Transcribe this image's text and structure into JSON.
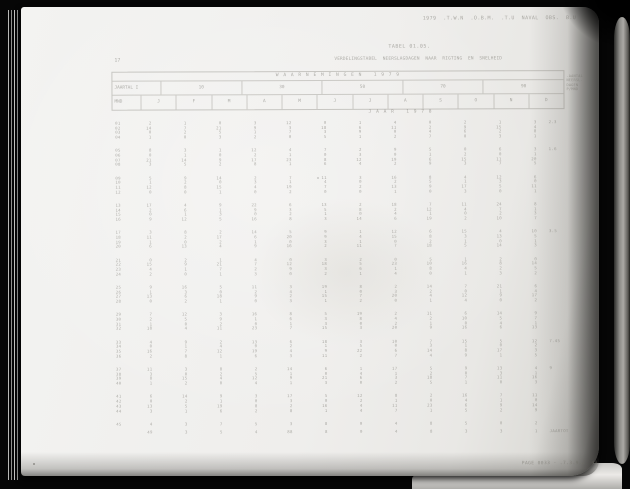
{
  "scan": {
    "top_right_line": "1979  .T.W.N  .O.B.M.  .T.U  NAVAL  OBS.  B.U",
    "table_ref": "TABEL 01.05.",
    "station_no": "17",
    "title_line": "VERDELINGSTABEL  NEERSLAGDAGEN  NAAR  RIGTING  EN  SNELHEID",
    "footer_line": "PAGE 0033 - .7.3.9.3  49"
  },
  "table": {
    "spanner": "W A A R N E M I N G E N   1 9 7 9",
    "year_label_cell": "JAARTAL I",
    "group_headers": [
      "10",
      "30",
      "50",
      "70",
      "90"
    ],
    "unit_cell": "MND",
    "month_headers": [
      "J",
      "F",
      "M",
      "A",
      "M",
      "J",
      "J",
      "A",
      "S",
      "O",
      "N",
      "D"
    ],
    "side_note_lines": [
      "-AANTAL",
      "NEERSL.",
      "DAGEN",
      "P/MND"
    ],
    "subtitle": "J A A R   1 9 7 8"
  },
  "table_body": {
    "groups": [
      {
        "note": "2.3",
        "rows": [
          {
            "label": "01",
            "values": [
              "2",
              "1",
              "0",
              "3",
              "12",
              "0",
              "1",
              "4",
              "0",
              "2",
              "1",
              "3"
            ]
          },
          {
            "label": "02",
            "values": [
              "14",
              "7",
              "21",
              "9",
              "3",
              "18",
              "6",
              "11",
              "2",
              "9",
              "15",
              "4"
            ]
          },
          {
            "label": "03",
            "values": [
              "0",
              "2",
              "5",
              "1",
              "7",
              "3",
              "9",
              "0",
              "4",
              "6",
              "2",
              "8"
            ]
          },
          {
            "label": "04",
            "values": [
              "1",
              "0",
              "3",
              "2",
              "0",
              "5",
              "1",
              "2",
              "7",
              "0",
              "3",
              "1"
            ]
          }
        ]
      },
      {
        "note": "1.6",
        "rows": [
          {
            "label": "05",
            "values": [
              "8",
              "3",
              "1",
              "12",
              "4",
              "7",
              "2",
              "9",
              "5",
              "0",
              "6",
              "3"
            ]
          },
          {
            "label": "06",
            "values": [
              "0",
              "1",
              "0",
              "2",
              "1",
              "0",
              "3",
              "0",
              "1",
              "2",
              "0",
              "1"
            ]
          },
          {
            "label": "07",
            "values": [
              "21",
              "14",
              "9",
              "17",
              "23",
              "8",
              "12",
              "19",
              "6",
              "15",
              "11",
              "20"
            ]
          },
          {
            "label": "08",
            "values": [
              "3",
              "5",
              "2",
              "8",
              "1",
              "6",
              "4",
              "2",
              "9",
              "3",
              "7",
              "5"
            ]
          }
        ]
      },
      {
        "note": "",
        "rows": [
          {
            "label": "09",
            "values": [
              "5",
              "9",
              "14",
              "2",
              "7",
              "11",
              "3",
              "16",
              "8",
              "4",
              "12",
              "6"
            ]
          },
          {
            "label": "10",
            "values": [
              "1",
              "2",
              "0",
              "3",
              "1",
              "4",
              "0",
              "2",
              "5",
              "1",
              "3",
              "0"
            ]
          },
          {
            "label": "11",
            "values": [
              "12",
              "8",
              "15",
              "4",
              "19",
              "7",
              "2",
              "13",
              "9",
              "17",
              "5",
              "11"
            ]
          },
          {
            "label": "12",
            "values": [
              "0",
              "0",
              "1",
              "0",
              "2",
              "0",
              "0",
              "1",
              "0",
              "3",
              "0",
              "1"
            ]
          }
        ]
      },
      {
        "note": "",
        "rows": [
          {
            "label": "13",
            "values": [
              "17",
              "4",
              "9",
              "22",
              "6",
              "13",
              "2",
              "18",
              "7",
              "11",
              "24",
              "8"
            ]
          },
          {
            "label": "14",
            "values": [
              "2",
              "6",
              "1",
              "9",
              "3",
              "5",
              "8",
              "2",
              "12",
              "4",
              "7",
              "1"
            ]
          },
          {
            "label": "15",
            "values": [
              "0",
              "1",
              "3",
              "0",
              "2",
              "1",
              "0",
              "4",
              "1",
              "0",
              "2",
              "3"
            ]
          },
          {
            "label": "16",
            "values": [
              "9",
              "12",
              "5",
              "16",
              "8",
              "3",
              "14",
              "6",
              "19",
              "2",
              "10",
              "7"
            ]
          }
        ]
      },
      {
        "note": "3.5",
        "rows": [
          {
            "label": "17",
            "values": [
              "3",
              "8",
              "2",
              "14",
              "5",
              "9",
              "1",
              "12",
              "6",
              "15",
              "4",
              "10"
            ]
          },
          {
            "label": "18",
            "values": [
              "11",
              "2",
              "17",
              "6",
              "20",
              "9",
              "4",
              "15",
              "8",
              "3",
              "13",
              "5"
            ]
          },
          {
            "label": "19",
            "values": [
              "1",
              "0",
              "2",
              "1",
              "0",
              "3",
              "1",
              "0",
              "2",
              "1",
              "0",
              "1"
            ]
          },
          {
            "label": "20",
            "values": [
              "6",
              "13",
              "4",
              "9",
              "16",
              "2",
              "11",
              "7",
              "18",
              "5",
              "14",
              "3"
            ]
          }
        ]
      },
      {
        "note": "",
        "rows": [
          {
            "label": "21",
            "values": [
              "0",
              "2",
              "1",
              "4",
              "0",
              "3",
              "2",
              "0",
              "5",
              "1",
              "2",
              "0"
            ]
          },
          {
            "label": "22",
            "values": [
              "15",
              "9",
              "21",
              "7",
              "12",
              "18",
              "5",
              "23",
              "10",
              "16",
              "8",
              "14"
            ]
          },
          {
            "label": "23",
            "values": [
              "4",
              "1",
              "7",
              "2",
              "9",
              "3",
              "6",
              "1",
              "8",
              "4",
              "2",
              "5"
            ]
          },
          {
            "label": "24",
            "values": [
              "2",
              "0",
              "1",
              "3",
              "0",
              "2",
              "1",
              "4",
              "0",
              "1",
              "3",
              "2"
            ]
          }
        ]
      },
      {
        "note": "",
        "rows": [
          {
            "label": "25",
            "values": [
              "9",
              "16",
              "5",
              "11",
              "3",
              "19",
              "8",
              "2",
              "14",
              "7",
              "21",
              "6"
            ]
          },
          {
            "label": "26",
            "values": [
              "1",
              "3",
              "0",
              "2",
              "4",
              "1",
              "0",
              "3",
              "2",
              "0",
              "1",
              "4"
            ]
          },
          {
            "label": "27",
            "values": [
              "13",
              "6",
              "18",
              "9",
              "2",
              "15",
              "7",
              "20",
              "4",
              "12",
              "9",
              "17"
            ]
          },
          {
            "label": "28",
            "values": [
              "0",
              "2",
              "1",
              "0",
              "3",
              "1",
              "2",
              "0",
              "1",
              "4",
              "0",
              "2"
            ]
          }
        ]
      },
      {
        "note": "",
        "rows": [
          {
            "label": "29",
            "values": [
              "7",
              "12",
              "3",
              "16",
              "8",
              "5",
              "19",
              "2",
              "11",
              "6",
              "14",
              "9"
            ]
          },
          {
            "label": "30",
            "values": [
              "2",
              "5",
              "9",
              "1",
              "6",
              "3",
              "8",
              "4",
              "2",
              "10",
              "5",
              "7"
            ]
          },
          {
            "label": "31",
            "values": [
              "1",
              "0",
              "2",
              "0",
              "1",
              "3",
              "0",
              "2",
              "1",
              "0",
              "4",
              "1"
            ]
          },
          {
            "label": "32",
            "values": [
              "18",
              "4",
              "11",
              "23",
              "7",
              "15",
              "3",
              "20",
              "9",
              "16",
              "6",
              "13"
            ]
          }
        ]
      },
      {
        "note": "7.45",
        "rows": [
          {
            "label": "33",
            "values": [
              "4",
              "9",
              "2",
              "13",
              "6",
              "18",
              "3",
              "10",
              "7",
              "15",
              "5",
              "12"
            ]
          },
          {
            "label": "34",
            "values": [
              "0",
              "1",
              "4",
              "0",
              "2",
              "1",
              "5",
              "0",
              "3",
              "1",
              "0",
              "2"
            ]
          },
          {
            "label": "35",
            "values": [
              "16",
              "7",
              "12",
              "19",
              "4",
              "9",
              "22",
              "6",
              "14",
              "8",
              "17",
              "3"
            ]
          },
          {
            "label": "36",
            "values": [
              "2",
              "8",
              "1",
              "6",
              "3",
              "11",
              "2",
              "7",
              "4",
              "9",
              "1",
              "5"
            ]
          }
        ]
      },
      {
        "note": "9",
        "rows": [
          {
            "label": "37",
            "values": [
              "11",
              "3",
              "8",
              "2",
              "14",
              "6",
              "1",
              "17",
              "5",
              "9",
              "13",
              "4"
            ]
          },
          {
            "label": "38",
            "values": [
              "3",
              "0",
              "2",
              "5",
              "1",
              "0",
              "4",
              "1",
              "2",
              "0",
              "3",
              "1"
            ]
          },
          {
            "label": "39",
            "values": [
              "8",
              "15",
              "4",
              "12",
              "9",
              "21",
              "6",
              "3",
              "18",
              "7",
              "11",
              "16"
            ]
          },
          {
            "label": "40",
            "values": [
              "1",
              "2",
              "0",
              "4",
              "1",
              "3",
              "0",
              "2",
              "5",
              "1",
              "0",
              "3"
            ]
          }
        ]
      },
      {
        "note": "",
        "rows": [
          {
            "label": "41",
            "values": [
              "6",
              "14",
              "9",
              "3",
              "17",
              "5",
              "12",
              "8",
              "2",
              "16",
              "7",
              "11"
            ]
          },
          {
            "label": "42",
            "values": [
              "0",
              "2",
              "1",
              "0",
              "3",
              "0",
              "2",
              "1",
              "0",
              "4",
              "1",
              "0"
            ]
          },
          {
            "label": "43",
            "values": [
              "13",
              "5",
              "19",
              "8",
              "2",
              "16",
              "4",
              "11",
              "23",
              "6",
              "9",
              "14"
            ]
          },
          {
            "label": "44",
            "values": [
              "3",
              "1",
              "6",
              "2",
              "8",
              "1",
              "4",
              "7",
              "1",
              "5",
              "2",
              "9"
            ]
          }
        ]
      }
    ],
    "single_row": {
      "label": "45",
      "values": [
        "4",
        "3",
        "7",
        "5",
        "3",
        "8",
        "0",
        "4",
        "8",
        "5",
        "0",
        "2"
      ],
      "note": ""
    },
    "total_row": {
      "label": "",
      "values": [
        "49",
        "3",
        "5",
        "4",
        "88",
        "8",
        "0",
        "4",
        "8",
        "3",
        "3",
        "1"
      ],
      "note": "JAARTOT"
    }
  },
  "colors": {
    "background": "#060606",
    "page": "#efeeec",
    "ink": "#706e66",
    "rule": "#807e76",
    "cover_strip": "#8d8c88"
  }
}
